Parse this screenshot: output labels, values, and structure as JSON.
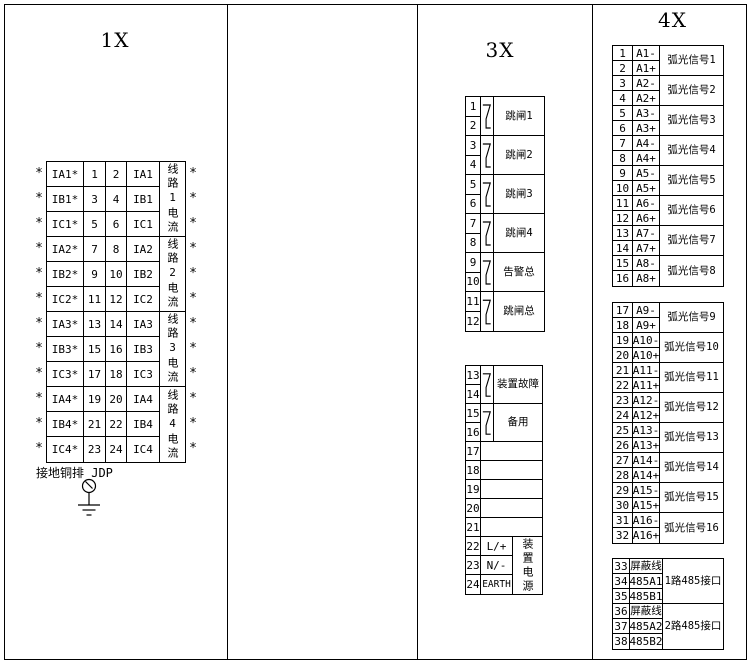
{
  "colors": {
    "line": "#000000",
    "background": "#ffffff"
  },
  "panels": {
    "p1x": {
      "title": "1X",
      "star": "*",
      "rows": [
        {
          "left": "IA1*",
          "n1": "1",
          "n2": "2",
          "right": "IA1"
        },
        {
          "left": "IB1*",
          "n1": "3",
          "n2": "4",
          "right": "IB1"
        },
        {
          "left": "IC1*",
          "n1": "5",
          "n2": "6",
          "right": "IC1"
        },
        {
          "left": "IA2*",
          "n1": "7",
          "n2": "8",
          "right": "IA2"
        },
        {
          "left": "IB2*",
          "n1": "9",
          "n2": "10",
          "right": "IB2"
        },
        {
          "left": "IC2*",
          "n1": "11",
          "n2": "12",
          "right": "IC2"
        },
        {
          "left": "IA3*",
          "n1": "13",
          "n2": "14",
          "right": "IA3"
        },
        {
          "left": "IB3*",
          "n1": "15",
          "n2": "16",
          "right": "IB3"
        },
        {
          "left": "IC3*",
          "n1": "17",
          "n2": "18",
          "right": "IC3"
        },
        {
          "left": "IA4*",
          "n1": "19",
          "n2": "20",
          "right": "IA4"
        },
        {
          "left": "IB4*",
          "n1": "21",
          "n2": "22",
          "right": "IB4"
        },
        {
          "left": "IC4*",
          "n1": "23",
          "n2": "24",
          "right": "IC4"
        }
      ],
      "groups": [
        "线路1电流",
        "线路2电流",
        "线路3电流",
        "线路4电流"
      ],
      "ground_label": "接地铜排 JDP"
    },
    "p3x": {
      "title": "3X",
      "relay_groups": [
        {
          "t1": "1",
          "t2": "2",
          "label": "跳闸1"
        },
        {
          "t1": "3",
          "t2": "4",
          "label": "跳闸2"
        },
        {
          "t1": "5",
          "t2": "6",
          "label": "跳闸3"
        },
        {
          "t1": "7",
          "t2": "8",
          "label": "跳闸4"
        },
        {
          "t1": "9",
          "t2": "10",
          "label": "告警总"
        },
        {
          "t1": "11",
          "t2": "12",
          "label": "跳闸总"
        }
      ],
      "lower_relay_groups": [
        {
          "t1": "13",
          "t2": "14",
          "label": "装置故障"
        },
        {
          "t1": "15",
          "t2": "16",
          "label": "备用"
        }
      ],
      "empty_terminals": [
        "17",
        "18",
        "19",
        "20",
        "21"
      ],
      "power_rows": [
        {
          "n": "22",
          "v": "L/+"
        },
        {
          "n": "23",
          "v": "N/-"
        },
        {
          "n": "24",
          "v": "EARTH"
        }
      ],
      "power_label": "装置电源"
    },
    "p4x": {
      "title": "4X",
      "signal_groups_a": [
        {
          "t1": "1",
          "v1": "A1-",
          "t2": "2",
          "v2": "A1+",
          "label": "弧光信号1"
        },
        {
          "t1": "3",
          "v1": "A2-",
          "t2": "4",
          "v2": "A2+",
          "label": "弧光信号2"
        },
        {
          "t1": "5",
          "v1": "A3-",
          "t2": "6",
          "v2": "A3+",
          "label": "弧光信号3"
        },
        {
          "t1": "7",
          "v1": "A4-",
          "t2": "8",
          "v2": "A4+",
          "label": "弧光信号4"
        },
        {
          "t1": "9",
          "v1": "A5-",
          "t2": "10",
          "v2": "A5+",
          "label": "弧光信号5"
        },
        {
          "t1": "11",
          "v1": "A6-",
          "t2": "12",
          "v2": "A6+",
          "label": "弧光信号6"
        },
        {
          "t1": "13",
          "v1": "A7-",
          "t2": "14",
          "v2": "A7+",
          "label": "弧光信号7"
        },
        {
          "t1": "15",
          "v1": "A8-",
          "t2": "16",
          "v2": "A8+",
          "label": "弧光信号8"
        }
      ],
      "signal_groups_b": [
        {
          "t1": "17",
          "v1": "A9-",
          "t2": "18",
          "v2": "A9+",
          "label": "弧光信号9"
        },
        {
          "t1": "19",
          "v1": "A10-",
          "t2": "20",
          "v2": "A10+",
          "label": "弧光信号10"
        },
        {
          "t1": "21",
          "v1": "A11-",
          "t2": "22",
          "v2": "A11+",
          "label": "弧光信号11"
        },
        {
          "t1": "23",
          "v1": "A12-",
          "t2": "24",
          "v2": "A12+",
          "label": "弧光信号12"
        },
        {
          "t1": "25",
          "v1": "A13-",
          "t2": "26",
          "v2": "A13+",
          "label": "弧光信号13"
        },
        {
          "t1": "27",
          "v1": "A14-",
          "t2": "28",
          "v2": "A14+",
          "label": "弧光信号14"
        },
        {
          "t1": "29",
          "v1": "A15-",
          "t2": "30",
          "v2": "A15+",
          "label": "弧光信号15"
        },
        {
          "t1": "31",
          "v1": "A16-",
          "t2": "32",
          "v2": "A16+",
          "label": "弧光信号16"
        }
      ],
      "comm_groups": [
        {
          "r1n": "33",
          "r1v": "屏蔽线",
          "r2n": "34",
          "r2v": "485A1",
          "r3n": "35",
          "r3v": "485B1",
          "label": "1路485接口"
        },
        {
          "r1n": "36",
          "r1v": "屏蔽线",
          "r2n": "37",
          "r2v": "485A2",
          "r3n": "38",
          "r3v": "485B2",
          "label": "2路485接口"
        }
      ]
    }
  }
}
